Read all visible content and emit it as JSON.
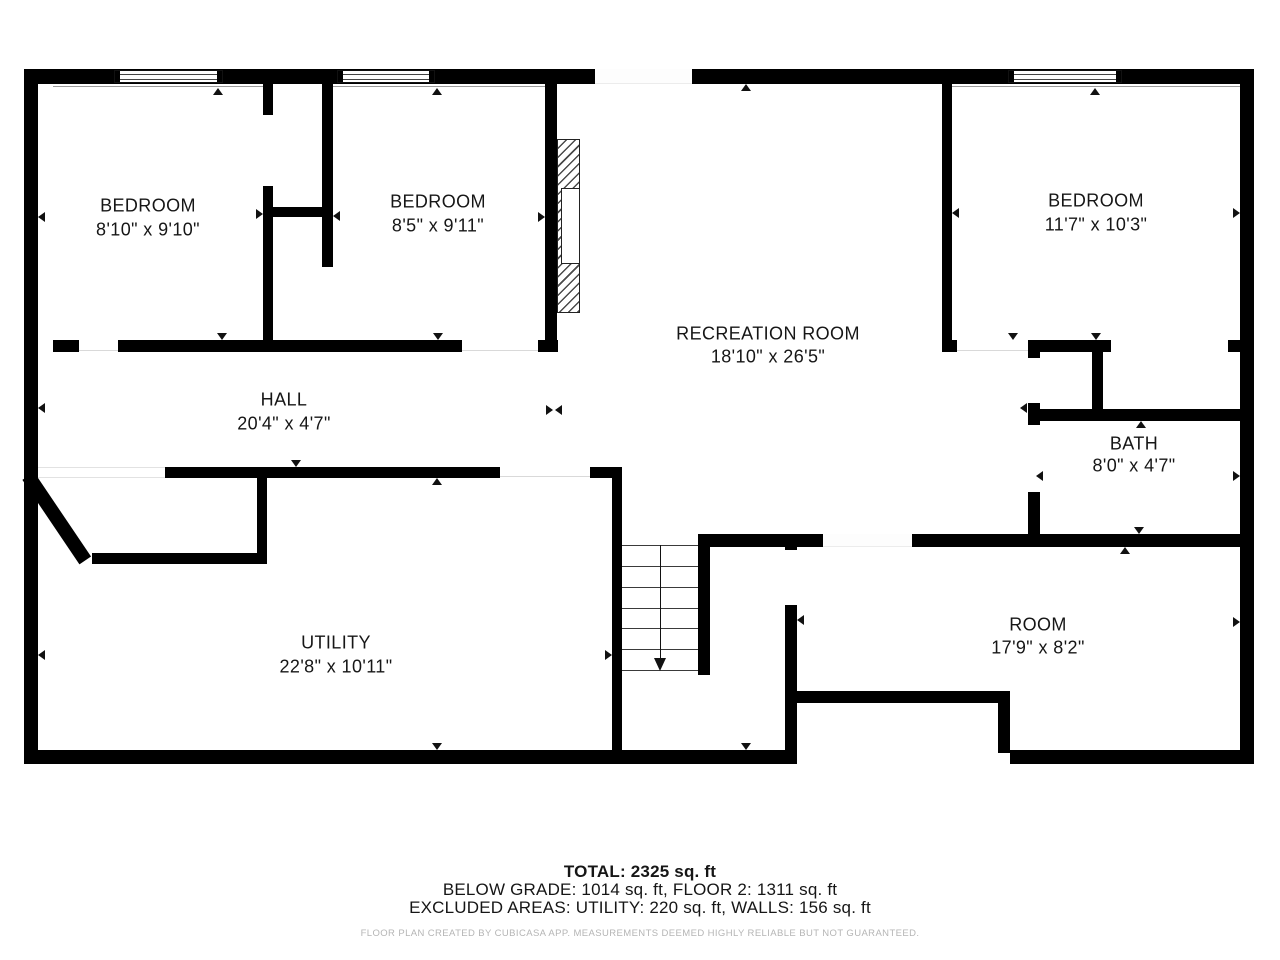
{
  "rooms": [
    {
      "name": "BEDROOM",
      "dims": "8'10\" x 9'10\"",
      "cx": 148,
      "cy_name": 206,
      "cy_dims": 230
    },
    {
      "name": "BEDROOM",
      "dims": "8'5\" x 9'11\"",
      "cx": 438,
      "cy_name": 202,
      "cy_dims": 226
    },
    {
      "name": "BEDROOM",
      "dims": "11'7\" x 10'3\"",
      "cx": 1096,
      "cy_name": 201,
      "cy_dims": 225
    },
    {
      "name": "RECREATION ROOM",
      "dims": "18'10\" x 26'5\"",
      "cx": 768,
      "cy_name": 334,
      "cy_dims": 357
    },
    {
      "name": "HALL",
      "dims": "20'4\" x 4'7\"",
      "cx": 284,
      "cy_name": 400,
      "cy_dims": 424
    },
    {
      "name": "BATH",
      "dims": "8'0\" x 4'7\"",
      "cx": 1134,
      "cy_name": 444,
      "cy_dims": 466
    },
    {
      "name": "UTILITY",
      "dims": "22'8\" x 10'11\"",
      "cx": 336,
      "cy_name": 643,
      "cy_dims": 667
    },
    {
      "name": "ROOM",
      "dims": "17'9\" x 8'2\"",
      "cx": 1038,
      "cy_name": 625,
      "cy_dims": 648
    }
  ],
  "summary": {
    "total": "TOTAL: 2325 sq. ft",
    "breakdown": "BELOW GRADE: 1014 sq. ft, FLOOR 2: 1311 sq. ft",
    "excluded": "EXCLUDED AREAS: UTILITY: 220 sq. ft, WALLS: 156 sq. ft",
    "disclaimer": "FLOOR PLAN CREATED BY CUBICASA APP. MEASUREMENTS DEEMED HIGHLY RELIABLE BUT NOT GUARANTEED."
  },
  "colors": {
    "wall": "#000000",
    "label": "#161616",
    "marker": "#111111",
    "disclaimer": "#b5b5b5"
  },
  "plan": {
    "walls": [
      [
        24,
        69,
        1230,
        15
      ],
      [
        24,
        69,
        14,
        695
      ],
      [
        1240,
        69,
        14,
        695
      ],
      [
        24,
        750,
        761,
        14
      ],
      [
        1010,
        750,
        244,
        14
      ],
      [
        53,
        340,
        26,
        12
      ],
      [
        118,
        340,
        344,
        12
      ],
      [
        538,
        340,
        20,
        12
      ],
      [
        263,
        207,
        70,
        10
      ],
      [
        942,
        340,
        15,
        12
      ],
      [
        1028,
        340,
        83,
        12
      ],
      [
        1228,
        340,
        12,
        12
      ],
      [
        165,
        467,
        335,
        11
      ],
      [
        590,
        467,
        32,
        11
      ],
      [
        92,
        553,
        175,
        11
      ],
      [
        1028,
        409,
        212,
        12
      ],
      [
        698,
        534,
        125,
        13
      ],
      [
        912,
        534,
        328,
        13
      ],
      [
        797,
        691,
        213,
        12
      ],
      [
        263,
        84,
        10,
        31
      ],
      [
        263,
        186,
        10,
        166
      ],
      [
        322,
        84,
        11,
        183
      ],
      [
        545,
        84,
        12,
        268
      ],
      [
        942,
        84,
        10,
        268
      ],
      [
        1028,
        340,
        12,
        18
      ],
      [
        1028,
        403,
        12,
        22
      ],
      [
        1028,
        492,
        12,
        53
      ],
      [
        1092,
        343,
        11,
        67
      ],
      [
        612,
        467,
        10,
        297
      ],
      [
        698,
        534,
        12,
        141
      ],
      [
        785,
        534,
        12,
        16
      ],
      [
        785,
        605,
        12,
        159
      ],
      [
        998,
        703,
        12,
        50
      ],
      [
        257,
        478,
        10,
        75
      ]
    ],
    "diagonal": {
      "x": 34,
      "y": 472,
      "len": 102,
      "th": 14,
      "angle": 56
    },
    "windows": [
      {
        "x": 114,
        "y": 70,
        "w": 109,
        "h": 13
      },
      {
        "x": 337,
        "y": 70,
        "w": 98,
        "h": 13
      },
      {
        "x": 1008,
        "y": 70,
        "w": 114,
        "h": 13
      }
    ],
    "entry_gap": {
      "x": 595,
      "y": 69,
      "w": 97,
      "h": 15
    },
    "room_gap": {
      "x": 823,
      "y": 534,
      "w": 89,
      "h": 13
    },
    "opening_strip": {
      "x": 38,
      "y": 467,
      "w": 127,
      "h": 11
    },
    "underlines": [
      [
        53,
        86,
        210
      ],
      [
        333,
        86,
        212
      ],
      [
        952,
        86,
        288
      ]
    ],
    "thresholds": [
      [
        79,
        350,
        39
      ],
      [
        462,
        350,
        76
      ],
      [
        957,
        350,
        71
      ],
      [
        500,
        476,
        90
      ]
    ],
    "markers": [
      {
        "x": 218,
        "y": 88,
        "dir": "up"
      },
      {
        "x": 437,
        "y": 88,
        "dir": "up"
      },
      {
        "x": 1095,
        "y": 88,
        "dir": "up"
      },
      {
        "x": 746,
        "y": 84,
        "dir": "up"
      },
      {
        "x": 437,
        "y": 478,
        "dir": "up"
      },
      {
        "x": 1125,
        "y": 547,
        "dir": "up"
      },
      {
        "x": 1141,
        "y": 421,
        "dir": "up"
      },
      {
        "x": 222,
        "y": 340,
        "dir": "down"
      },
      {
        "x": 438,
        "y": 340,
        "dir": "down"
      },
      {
        "x": 1096,
        "y": 340,
        "dir": "down"
      },
      {
        "x": 1013,
        "y": 340,
        "dir": "down"
      },
      {
        "x": 296,
        "y": 467,
        "dir": "down"
      },
      {
        "x": 437,
        "y": 750,
        "dir": "down"
      },
      {
        "x": 746,
        "y": 750,
        "dir": "down"
      },
      {
        "x": 1139,
        "y": 534,
        "dir": "down"
      },
      {
        "x": 38,
        "y": 217,
        "dir": "left"
      },
      {
        "x": 952,
        "y": 213,
        "dir": "left"
      },
      {
        "x": 38,
        "y": 408,
        "dir": "left"
      },
      {
        "x": 38,
        "y": 655,
        "dir": "left"
      },
      {
        "x": 797,
        "y": 620,
        "dir": "left"
      },
      {
        "x": 1036,
        "y": 476,
        "dir": "left"
      },
      {
        "x": 333,
        "y": 216,
        "dir": "left"
      },
      {
        "x": 1020,
        "y": 408,
        "dir": "left"
      },
      {
        "x": 555,
        "y": 410,
        "dir": "left"
      },
      {
        "x": 263,
        "y": 214,
        "dir": "right"
      },
      {
        "x": 545,
        "y": 217,
        "dir": "right"
      },
      {
        "x": 1240,
        "y": 213,
        "dir": "right"
      },
      {
        "x": 1240,
        "y": 622,
        "dir": "right"
      },
      {
        "x": 1240,
        "y": 476,
        "dir": "right"
      },
      {
        "x": 612,
        "y": 655,
        "dir": "right"
      },
      {
        "x": 553,
        "y": 410,
        "dir": "right"
      }
    ],
    "stairs": {
      "x": 622,
      "y": 545,
      "w": 76,
      "h": 127,
      "treads": 7,
      "arrow_x": 660
    },
    "fireplace": {
      "x": 557,
      "y": 139,
      "w": 23,
      "h": 174,
      "box": {
        "x": 561,
        "y": 188,
        "w": 19,
        "h": 76
      }
    }
  }
}
